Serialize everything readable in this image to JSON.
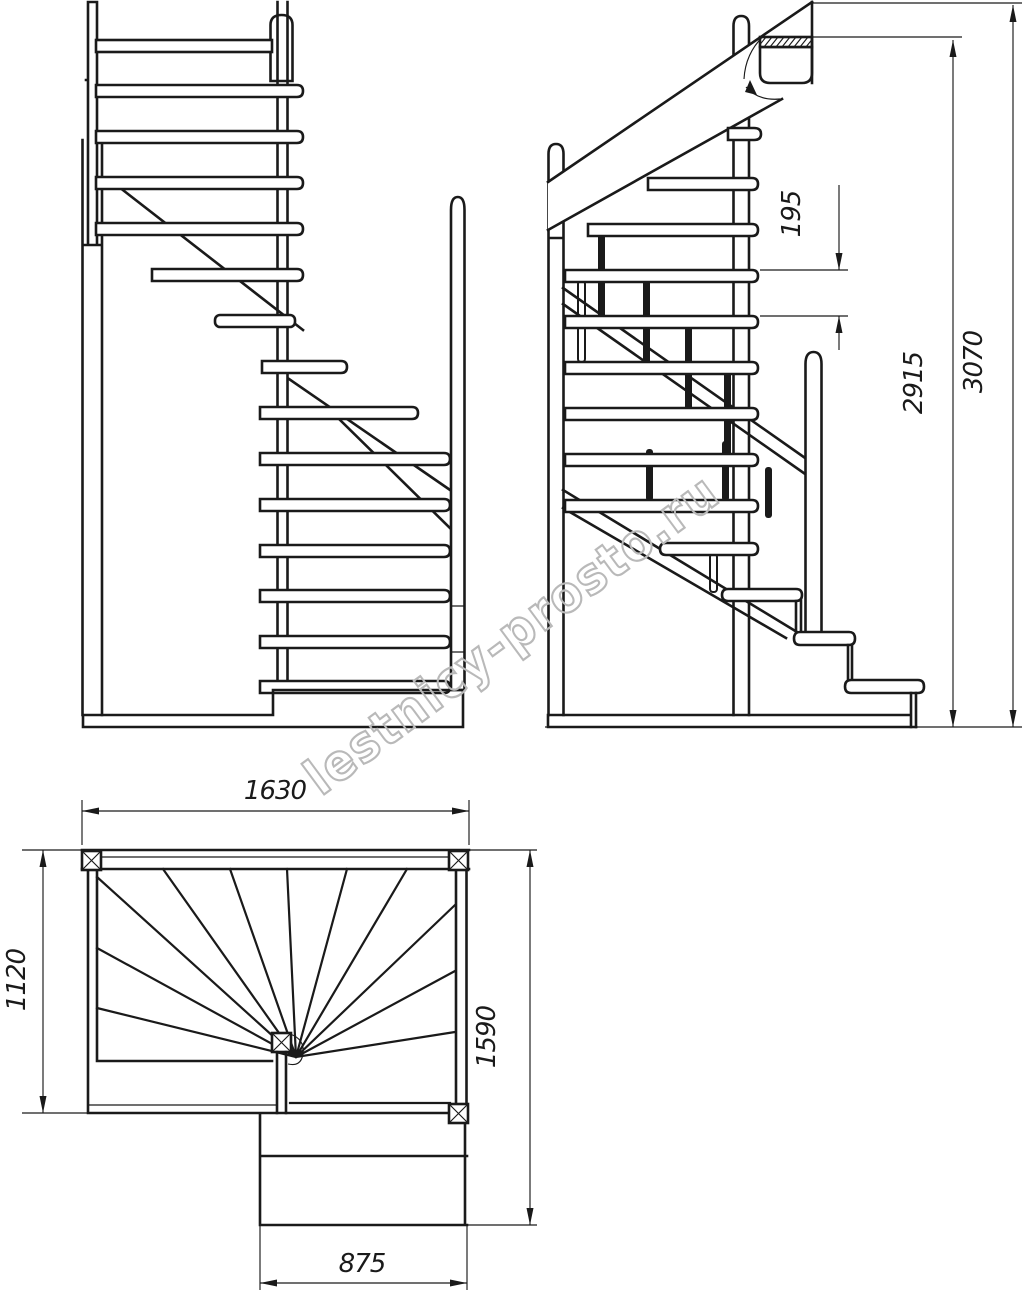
{
  "colors": {
    "ink": "#1a1a1a",
    "watermark": "#b9b9b9",
    "paper": "#ffffff"
  },
  "watermark": {
    "text": "lestnicy-prosto.ru"
  },
  "dimensions": {
    "riser_height": "195",
    "floor_to_slab_height": "2915",
    "total_height": "3070",
    "plan_width": "1630",
    "plan_left_depth": "1120",
    "plan_right_depth": "1590",
    "lower_flight_width": "875"
  }
}
